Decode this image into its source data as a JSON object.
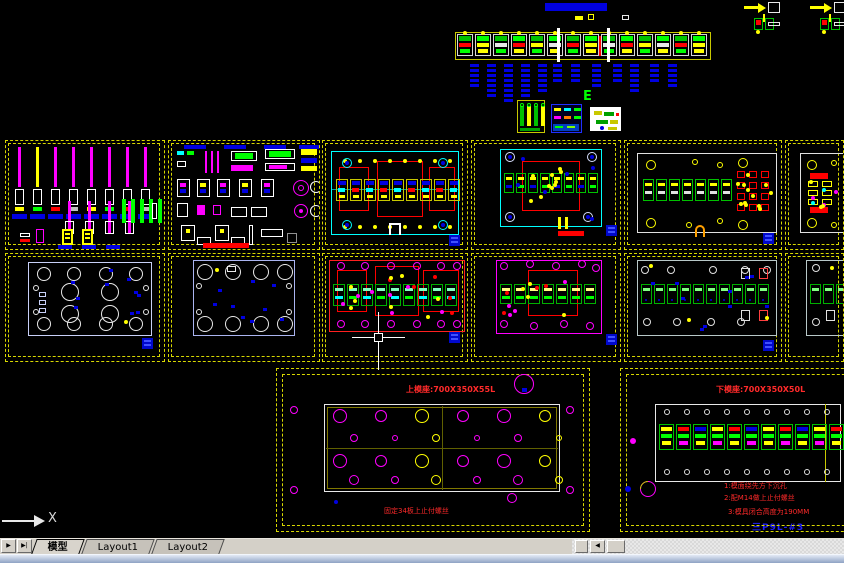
{
  "app": {
    "type": "cad-model-space"
  },
  "colors": {
    "bg": "#000000",
    "frame": "#d8d800",
    "magenta": "#ff00ff",
    "cyan": "#00ffff",
    "red": "#ff0000",
    "green": "#00ff00",
    "blue": "#0000e0",
    "white": "#e8e8e8",
    "gray_plate": "#b8c8c8",
    "ui_bg": "#d4d0c8"
  },
  "labels": {
    "e_marker": "E",
    "part_label": "三P9L-#3",
    "ucs_x": "X"
  },
  "drawings": {
    "upper_die": {
      "title": "上模座:700X350X55L",
      "note": "固定34板上止付螺丝"
    },
    "lower_die": {
      "title": "下模座:700X350X50L",
      "notes": [
        "1:模面绕先方下沉孔",
        "2:配M14做上止付螺丝",
        "3:模具闭合高度为190MM"
      ]
    }
  },
  "tabs": {
    "nav": [
      "▶",
      "▶|"
    ],
    "items": [
      {
        "label": "模型",
        "active": true
      },
      {
        "label": "Layout1",
        "active": false
      },
      {
        "label": "Layout2",
        "active": false
      }
    ]
  },
  "scrollbar": {
    "left_arrow": "◀"
  },
  "panels": [
    {
      "id": "r1c1",
      "x": 5,
      "y": 140,
      "w": 160,
      "h": 110,
      "kind": "punch-pins"
    },
    {
      "id": "r1c2",
      "x": 168,
      "y": 140,
      "w": 152,
      "h": 110,
      "kind": "small-parts"
    },
    {
      "id": "r1c3",
      "x": 322,
      "y": 140,
      "w": 146,
      "h": 110,
      "kind": "plate-cyan-3red"
    },
    {
      "id": "r1c4",
      "x": 471,
      "y": 140,
      "w": 150,
      "h": 110,
      "kind": "plate-cyan-1red"
    },
    {
      "id": "r1c5",
      "x": 624,
      "y": 140,
      "w": 158,
      "h": 110,
      "kind": "plate-white-cluster"
    },
    {
      "id": "r1c6",
      "x": 785,
      "y": 140,
      "w": 59,
      "h": 110,
      "kind": "plate-white-partial"
    },
    {
      "id": "r2c1",
      "x": 5,
      "y": 253,
      "w": 160,
      "h": 109,
      "kind": "holes-plate-a"
    },
    {
      "id": "r2c2",
      "x": 168,
      "y": 253,
      "w": 152,
      "h": 109,
      "kind": "holes-plate-b"
    },
    {
      "id": "r2c3",
      "x": 322,
      "y": 253,
      "w": 146,
      "h": 109,
      "kind": "plate-red-strip"
    },
    {
      "id": "r2c4",
      "x": 471,
      "y": 253,
      "w": 150,
      "h": 109,
      "kind": "plate-magenta-strip"
    },
    {
      "id": "r2c5",
      "x": 624,
      "y": 253,
      "w": 158,
      "h": 109,
      "kind": "plate-gray-strip"
    },
    {
      "id": "r2c6",
      "x": 785,
      "y": 253,
      "w": 59,
      "h": 109,
      "kind": "plate-gray-partial"
    }
  ],
  "decor": {
    "strip": {
      "x": 455,
      "y": 32,
      "w": 256,
      "h": 28,
      "stations": 14,
      "blue_bar": {
        "x": 545,
        "y": 3,
        "w": 62,
        "h": 8
      },
      "stacks": {
        "y": 64,
        "cols": [
          [
            470,
            5
          ],
          [
            487,
            7
          ],
          [
            504,
            8
          ],
          [
            521,
            7
          ],
          [
            538,
            6
          ],
          [
            553,
            4
          ],
          [
            571,
            4
          ],
          [
            592,
            5
          ],
          [
            613,
            4
          ],
          [
            630,
            6
          ],
          [
            650,
            4
          ],
          [
            668,
            5
          ]
        ]
      }
    },
    "arrow_details": [
      [
        744,
        2
      ],
      [
        810,
        2
      ]
    ],
    "part_details": [
      [
        752,
        14
      ],
      [
        818,
        14
      ]
    ],
    "blocks": [
      {
        "x": 517,
        "y": 100,
        "w": 30,
        "h": 35,
        "style": "yellow"
      },
      {
        "x": 551,
        "y": 104,
        "w": 33,
        "h": 31,
        "style": "blue"
      },
      {
        "x": 590,
        "y": 107,
        "w": 33,
        "h": 26,
        "style": "white"
      }
    ],
    "bottom_left": {
      "x": 276,
      "y": 368,
      "w": 316,
      "h": 166,
      "plate": {
        "x": 48,
        "y": 36,
        "w": 236,
        "h": 88
      },
      "circle": {
        "x": 248,
        "y": 16,
        "r": 10
      }
    },
    "bottom_right": {
      "x": 620,
      "y": 368,
      "w": 224,
      "h": 166,
      "plate": {
        "x": 35,
        "y": 36,
        "w": 186,
        "h": 78
      },
      "vline_x": 170
    },
    "crosshair": {
      "x": 378,
      "y": 338
    },
    "ucs": {
      "x": 0,
      "y": 510
    }
  }
}
